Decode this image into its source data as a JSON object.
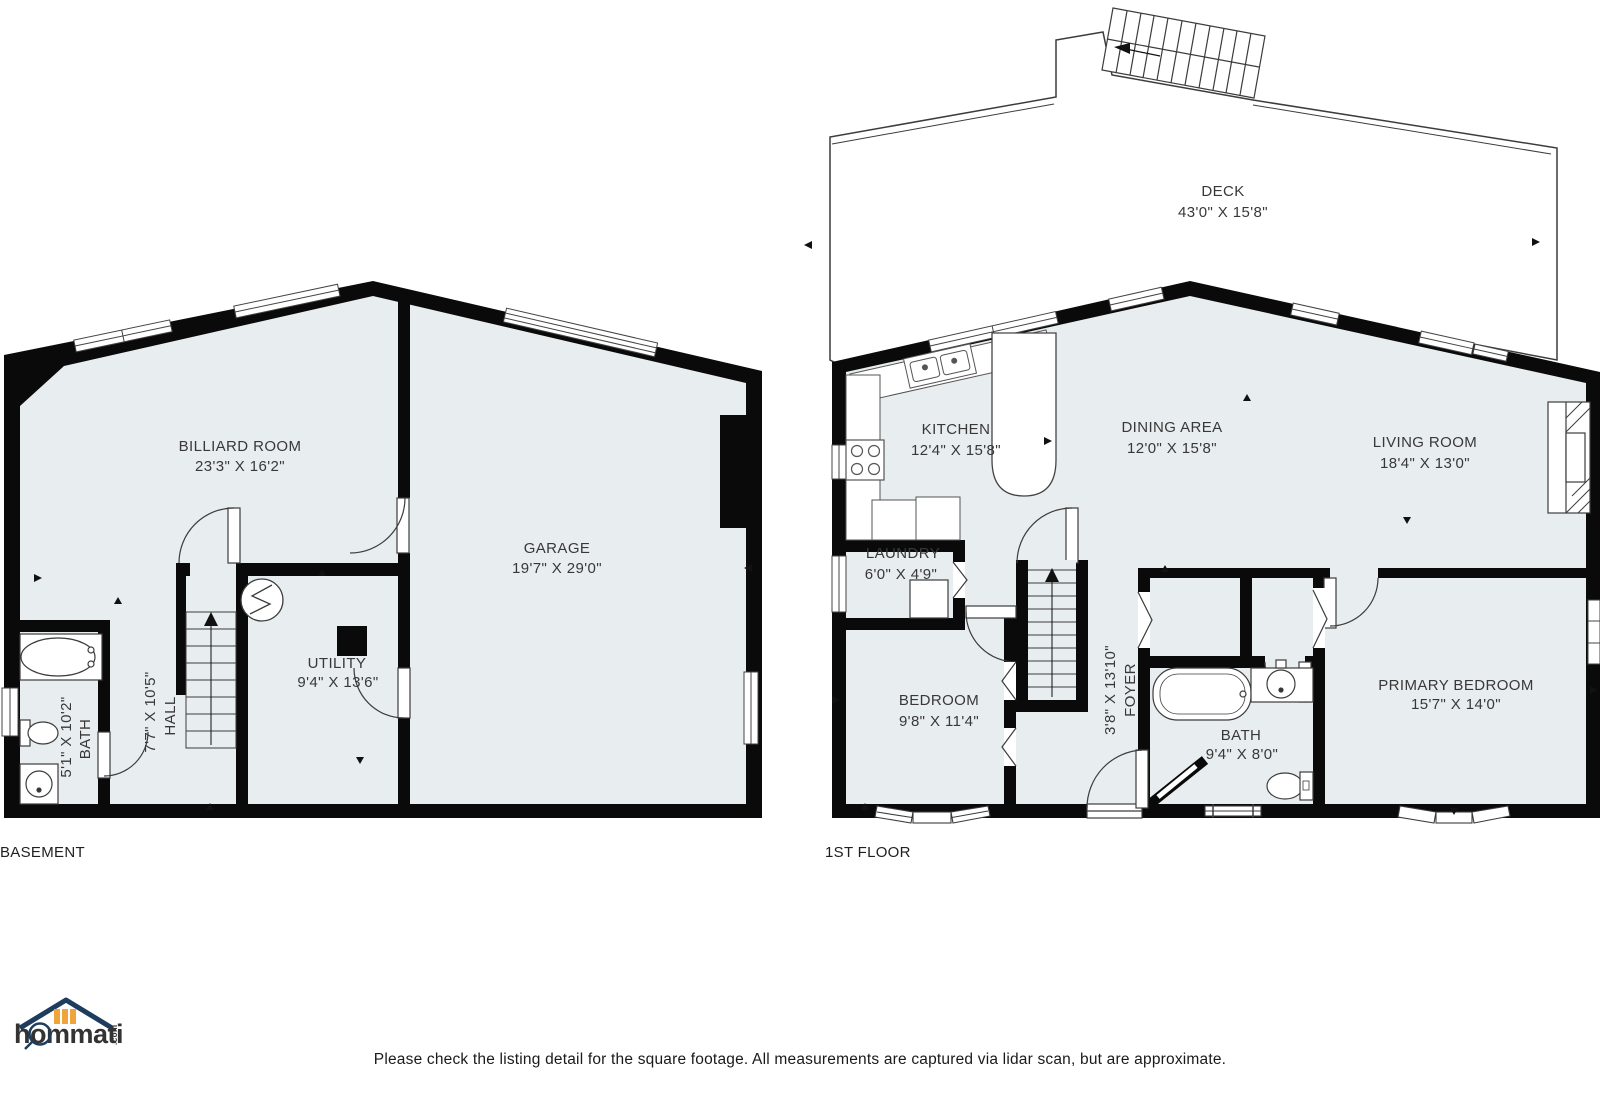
{
  "page": {
    "background": "#ffffff",
    "floor_fill": "#e8edef",
    "wall_color": "#0a0a0a",
    "thin_line_color": "#3c3c3c",
    "text_color": "#383838",
    "disclaimer": "Please check the listing detail for the square footage. All measurements are captured via lidar scan, but are approximate."
  },
  "logo": {
    "brand": "hommati",
    "tld": ".com",
    "navy": "#1d3c5e",
    "orange": "#f0a43c"
  },
  "basement": {
    "label": "BASEMENT",
    "rooms": {
      "billiard": {
        "name": "BILLIARD ROOM",
        "dims": "23'3\" X 16'2\""
      },
      "garage": {
        "name": "GARAGE",
        "dims": "19'7\" X 29'0\""
      },
      "utility": {
        "name": "UTILITY",
        "dims": "9'4\" X 13'6\""
      },
      "hall": {
        "name": "HALL",
        "dims": "7'7\" X 10'5\""
      },
      "bath": {
        "name": "BATH",
        "dims": "5'1\" X 10'2\""
      }
    }
  },
  "first_floor": {
    "label": "1ST FLOOR",
    "rooms": {
      "deck": {
        "name": "DECK",
        "dims": "43'0\" X 15'8\""
      },
      "kitchen": {
        "name": "KITCHEN",
        "dims": "12'4\" X 15'8\""
      },
      "dining": {
        "name": "DINING AREA",
        "dims": "12'0\" X 15'8\""
      },
      "living": {
        "name": "LIVING ROOM",
        "dims": "18'4\" X 13'0\""
      },
      "laundry": {
        "name": "LAUNDRY",
        "dims": "6'0\" X 4'9\""
      },
      "bedroom": {
        "name": "BEDROOM",
        "dims": "9'8\" X 11'4\""
      },
      "foyer": {
        "name": "FOYER",
        "dims": "3'8\" X 13'10\""
      },
      "bath": {
        "name": "BATH",
        "dims": "9'4\" X 8'0\""
      },
      "primary": {
        "name": "PRIMARY BEDROOM",
        "dims": "15'7\" X 14'0\""
      }
    }
  }
}
